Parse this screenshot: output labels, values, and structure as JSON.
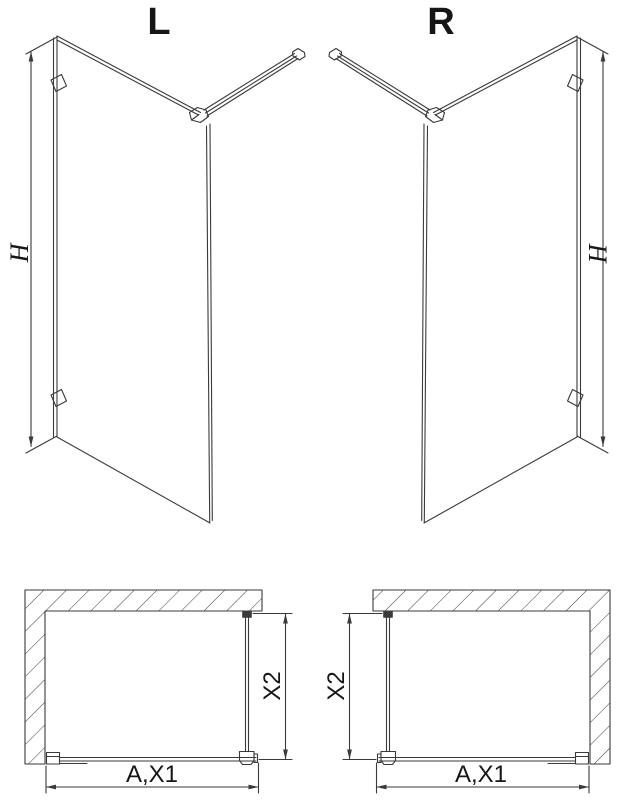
{
  "drawing": {
    "line_color": "#3a3a3a",
    "background": "#ffffff",
    "views": {
      "left_3d": {
        "variant_label": "L",
        "height_dim_label": "H"
      },
      "right_3d": {
        "variant_label": "R",
        "height_dim_label": "H"
      },
      "left_top": {
        "width_dim_label": "A,X1",
        "depth_dim_label": "X2"
      },
      "right_top": {
        "width_dim_label": "A,X1",
        "depth_dim_label": "X2"
      }
    }
  }
}
